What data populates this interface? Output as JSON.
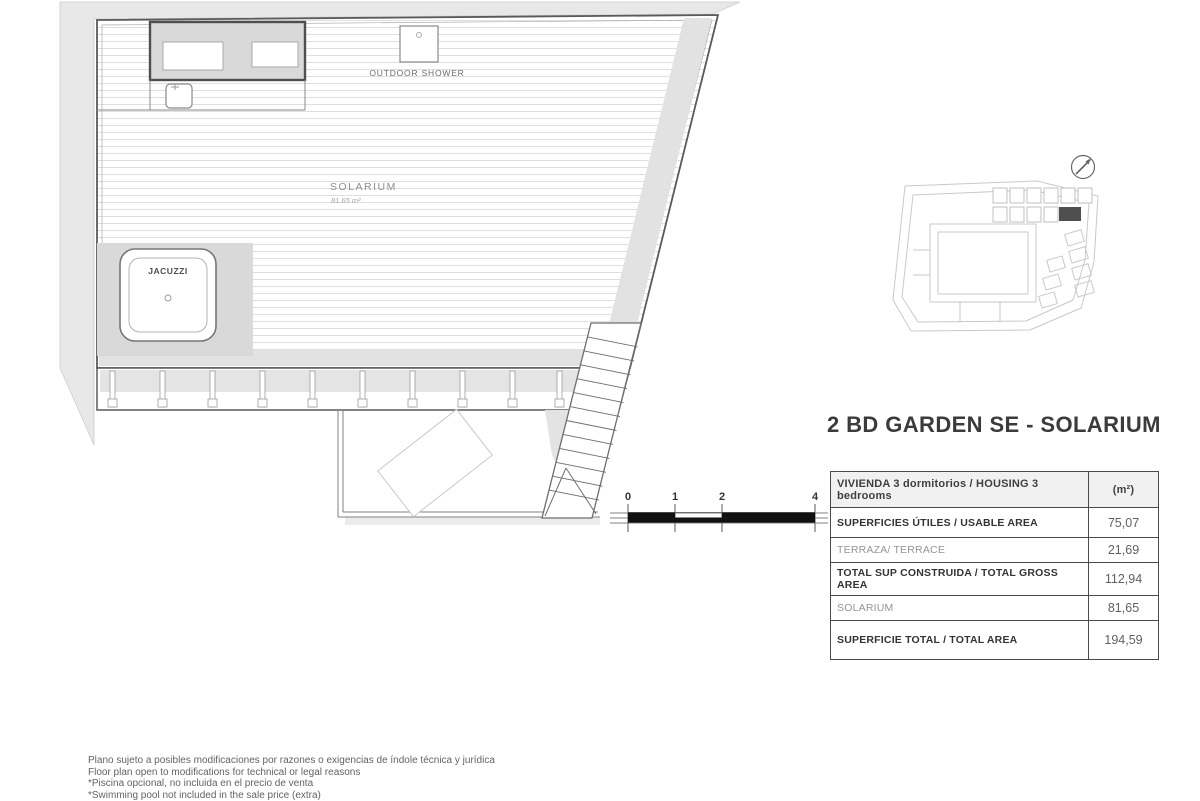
{
  "title": "2 BD GARDEN SE - SOLARIUM",
  "plan": {
    "solarium_label": "SOLARIUM",
    "solarium_area": "81.65 m²",
    "jacuzzi_label": "JACUZZI",
    "outdoor_shower_label": "OUTDOOR SHOWER"
  },
  "scale_bar": {
    "labels": [
      "0",
      "1",
      "2",
      "4"
    ]
  },
  "area_table": {
    "header_label": "VIVIENDA 3 dormitorios / HOUSING 3 bedrooms",
    "header_unit": "(m²)",
    "rows": [
      {
        "label": "SUPERFICIES ÚTILES / USABLE AREA",
        "value": "75,07"
      },
      {
        "label": "TERRAZA/ TERRACE",
        "value": "21,69"
      },
      {
        "label": "TOTAL SUP CONSTRUIDA / TOTAL GROSS AREA",
        "value": "112,94"
      },
      {
        "label": "SOLARIUM",
        "value": "81,65"
      },
      {
        "label": "SUPERFICIE TOTAL / TOTAL  AREA",
        "value": "194,59"
      }
    ]
  },
  "footnotes": [
    "Plano sujeto a posibles modificaciones por razones o exigencias de índole técnica y jurídica",
    "Floor plan open to modifications for technical or legal reasons",
    "*Piscina opcional, no incluida en el precio de venta",
    "*Swimming pool not included in the sale price (extra)"
  ],
  "colors": {
    "drawing_line": "#5a5a5a",
    "shading": "#e8e8e8",
    "highlight_unit": "#4f4f4f"
  }
}
